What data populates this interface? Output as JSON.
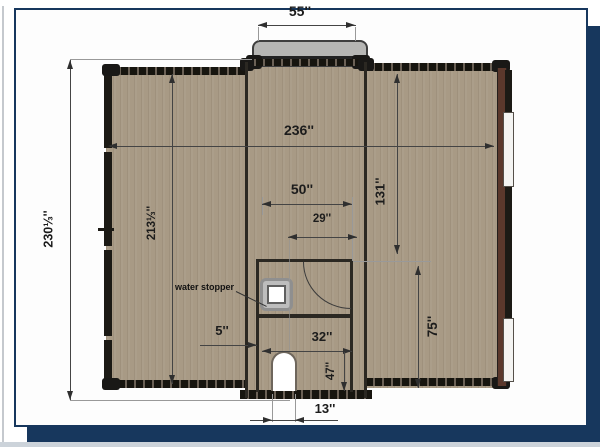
{
  "plan": {
    "title_context": "floor-plan drawing on slide card",
    "annotations": {
      "width_steps": "55''",
      "width_total": "236''",
      "height_total": "230⅓''",
      "height_left_wing": "213⅓''",
      "height_right_interior": "131''",
      "width_bath_top": "50''",
      "width_bath_inner": "29''",
      "height_bath_right": "75''",
      "offset_wall": "5''",
      "width_bath_lower": "32''",
      "height_bath_lower": "47''",
      "width_door": "13''",
      "water_stopper": "water stopper"
    },
    "colors": {
      "frame_navy": "#17375d",
      "floor_tan": "#a89a85",
      "wall_dark": "#2b2822",
      "steps_grey": "#b6b6b4",
      "right_wall_maroon": "#5b382c",
      "dim_line": "#444444"
    }
  }
}
